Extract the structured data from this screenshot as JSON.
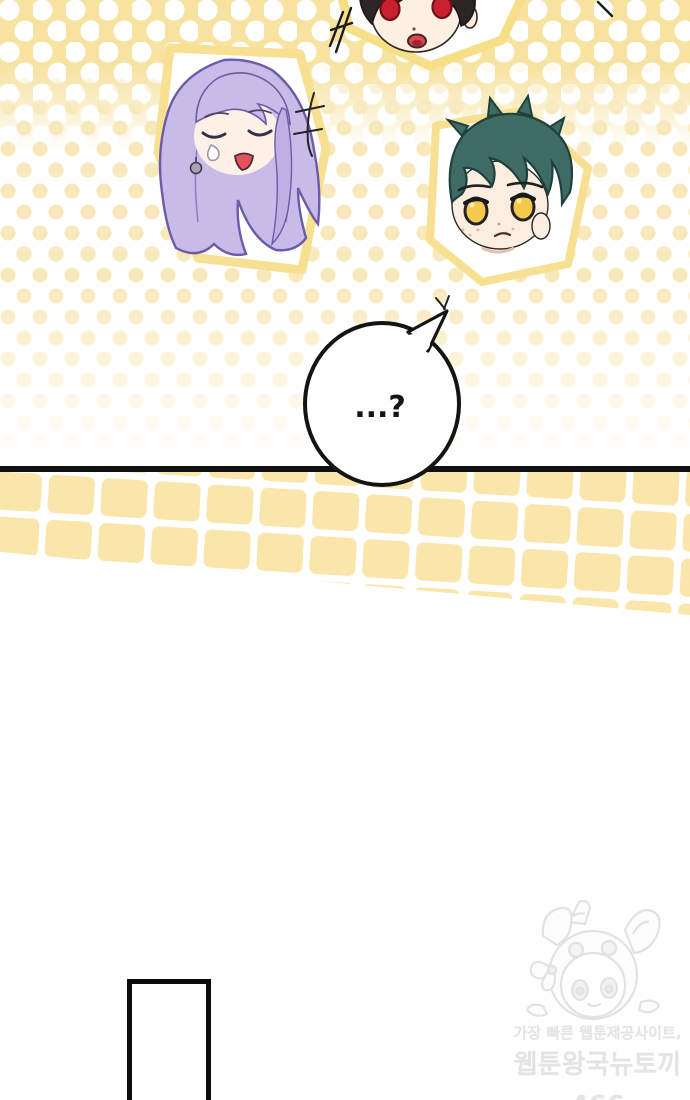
{
  "comic": {
    "speech_bubble": {
      "text": "...?"
    },
    "watermark": {
      "tagline": "가장 빠른 웹툰제공사이트,",
      "site_name": "웹툰왕국뉴토끼466",
      "site_url": "HTTPS://NEWTOKI466.COM"
    },
    "stickers": [
      {
        "name": "red-eyed-character-sticker"
      },
      {
        "name": "purple-haired-character-sticker"
      },
      {
        "name": "green-haired-character-sticker"
      }
    ],
    "colors": {
      "halftone_yellow": "#F7E2A0",
      "halftone_dot_pale": "#F8E9BC",
      "tile_yellow": "#FAE5AB",
      "sticker_border_yellow": "#F8E092",
      "panel_line_black": "#101010",
      "watermark_gray": "#E4E4E4",
      "purple_hair": "#C9BBE7",
      "teal_hair": "#3E6B64",
      "red_eyes": "#C8202E",
      "yellow_eyes": "#F5C84E"
    }
  }
}
